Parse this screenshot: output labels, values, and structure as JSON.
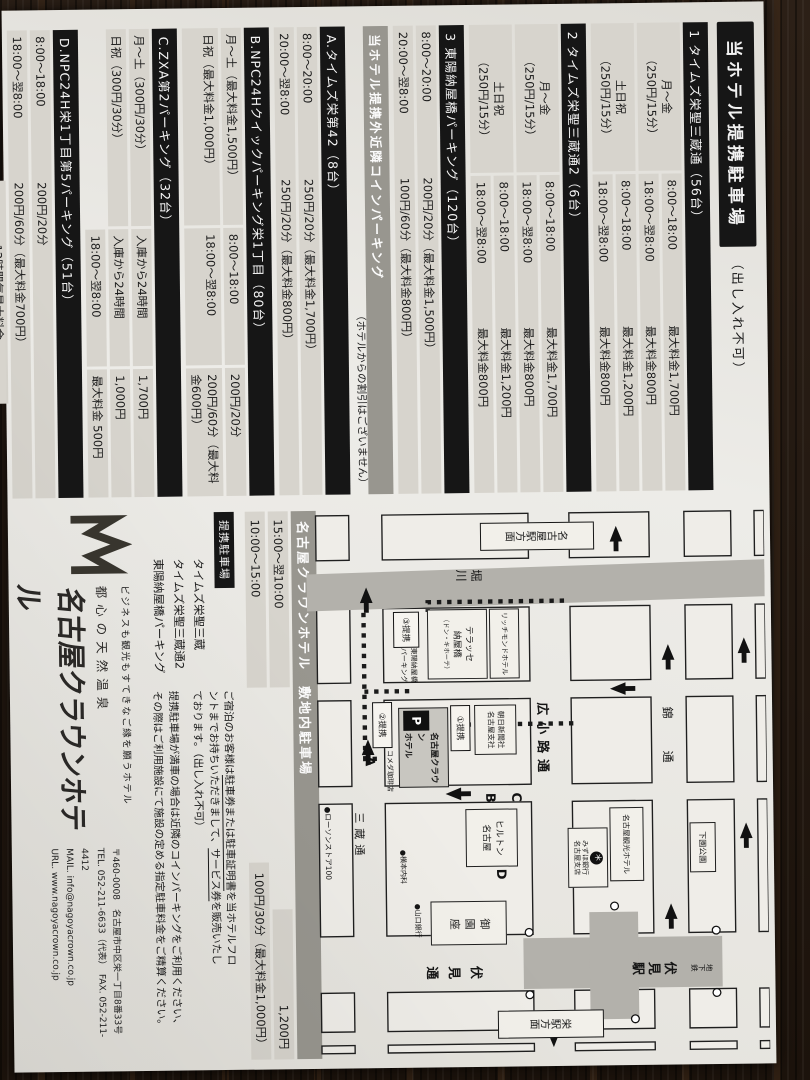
{
  "title": {
    "main": "当ホテル提携駐車場",
    "suffix": "（出し入れ不可）"
  },
  "partner_lots": [
    {
      "name": "1 タイムズ栄聖三蔵通（56台）",
      "groups": [
        {
          "label": "月～金",
          "rate": "（250円/15分）",
          "rows": [
            {
              "time": "8:00～18:00",
              "fee": "最大料金1,700円"
            },
            {
              "time": "18:00～翌8:00",
              "fee": "最大料金800円"
            }
          ]
        },
        {
          "label": "土日祝",
          "rate": "（250円/15分）",
          "rows": [
            {
              "time": "8:00～18:00",
              "fee": "最大料金1,200円"
            },
            {
              "time": "18:00～翌8:00",
              "fee": "最大料金800円"
            }
          ]
        }
      ]
    },
    {
      "name": "2 タイムズ栄聖三蔵通2（6台）",
      "groups": [
        {
          "label": "月～金",
          "rate": "（250円/15分）",
          "rows": [
            {
              "time": "8:00～18:00",
              "fee": "最大料金1,700円"
            },
            {
              "time": "18:00～翌8:00",
              "fee": "最大料金800円"
            }
          ]
        },
        {
          "label": "土日祝",
          "rate": "（250円/15分）",
          "rows": [
            {
              "time": "8:00～18:00",
              "fee": "最大料金1,200円"
            },
            {
              "time": "18:00～翌8:00",
              "fee": "最大料金800円"
            }
          ]
        }
      ]
    },
    {
      "name": "3 東陽納屋橋パーキング（120台）",
      "rows": [
        {
          "time": "8:00～20:00",
          "fee": "200円/20分（最大料金1,500円）"
        },
        {
          "time": "20:00～翌8:00",
          "fee": "100円/60分（最大料金800円）"
        }
      ]
    }
  ],
  "coin_section": {
    "title": "当ホテル提携外近隣コインパーキング",
    "note": "（ホテルからの割引はございません）"
  },
  "coin_lots": [
    {
      "name": "A.タイムズ栄第42（8台）",
      "rows": [
        {
          "time": "8:00～20:00",
          "fee": "250円/20分（最大料金1,700円）"
        },
        {
          "time": "20:00～翌8:00",
          "fee": "250円/20分（最大料金800円）"
        }
      ]
    },
    {
      "name": "B.NPC24Hクイックパーキング栄1丁目（80台）",
      "rows": [
        {
          "label": "月～土（最大料金1,500円）",
          "time": "8:00～18:00",
          "fee": "200円/20分"
        },
        {
          "label": "日祝（最大料金1,000円）",
          "time": "18:00～翌8:00",
          "fee": "200円/60分（最大料金600円）"
        }
      ]
    },
    {
      "name": "C.ZXA第2パーキング（32台）",
      "rows": [
        {
          "label": "月～土（300円/30分）",
          "time": "入庫から24時間",
          "fee": "1,700円"
        },
        {
          "label": "日祝（300円/30分）",
          "time": "入庫から24時間",
          "fee": "1,000円"
        },
        {
          "label": "",
          "time": "18:00～翌8:00",
          "fee": "最大料金 500円"
        }
      ]
    },
    {
      "name": "D.NPC24H栄1丁目第5パーキング（51台）",
      "rows": [
        {
          "time": "8:00～18:00",
          "fee": "200円/20分"
        },
        {
          "time": "18:00～翌8:00",
          "fee": "200円/60分（最大料金700円）"
        }
      ],
      "extra_label": "12時間毎最大料金",
      "extra_value": "2,000円"
    }
  ],
  "footnote": "※各コインパーキングの料金は2025年6月現在のものであり改定される場合がございます。予めご了承ください。",
  "onsite": {
    "title": "名古屋クラウンホテル　敷地内駐車場",
    "rows": [
      {
        "time": "15:00～翌10:00",
        "fee": "1,200円"
      },
      {
        "time": "10:00～15:00",
        "fee": "100円/30分（最大料金1,000円）"
      }
    ]
  },
  "tie_up": {
    "title": "提携駐車場",
    "list": [
      "タイムズ栄聖三蔵",
      "タイムズ栄聖三蔵通2",
      "東陽納屋橋パーキング"
    ],
    "p1a": "ご宿泊のお客様は",
    "p1b": "駐車券または駐車証明書",
    "p1c": "を当ホテルフロ",
    "p2a": "ントまでお持ちいただきまして、",
    "p2b": "サービス券",
    "p2c": "を販売いたし",
    "p3": "ております。（出し入れ不可）",
    "q1": "提携駐車場が満車の場合は近隣のコインパーキングをご利用ください、",
    "q2": "その際はご利用施設にて施設の定める指定駐車料金をご精算ください。"
  },
  "hotel": {
    "tagline": "ビジネスも観光もすてきなご縁を願うホテル",
    "onsen": "都心の天然温泉",
    "name": "名古屋クラウンホテル",
    "zip": "〒460-0008　名古屋市中区栄一丁目8番33号",
    "tel": "TEL. 052-211-6633（代表）　FAX. 052-211-4412",
    "mail": "MAIL. info@nagoyacrown.co.jp",
    "url": "URL. www.nagoyacrown.co.jp"
  },
  "map": {
    "horikawa": "堀川",
    "nishiki": "錦　通",
    "hirokoji": "広小路通",
    "sanzo": "三蔵通",
    "fushimi_dori": "伏見通",
    "subway": "地下鉄",
    "fushimi_sta": "伏見駅",
    "nagoya_sta": "名古屋駅方面",
    "sakae_sta": "栄駅方面",
    "shimozono": "下園公園",
    "kanko": "名古屋観光ホテル",
    "mizuho1": "みずほ銀行",
    "mizuho2": "名古屋支店",
    "bank_mark": "＊",
    "richmond": "リッチモンドホテル",
    "terrasse1": "テラッセ",
    "terrasse2": "納屋橋",
    "terrasse3": "（ドン・キホーテ）",
    "asahi1": "朝日新聞社",
    "asahi2": "名古屋支社",
    "hilton1": "ヒルトン",
    "hilton2": "名古屋",
    "misonoza": "御園座",
    "komeda": "コメダ珈琲店",
    "lawson": "●ローソンストア100",
    "yamaguchi": "●山口銀行",
    "yokomoto": "●横本内科",
    "crown1": "名古屋クラウン",
    "crown2": "ホテル",
    "p": "P",
    "toyo1": "東陽納屋橋",
    "toyo2": "パーキング",
    "m1": "①提携",
    "m2": "②提携",
    "m3": "③提携",
    "a": "A",
    "b": "B",
    "c": "C",
    "d": "D"
  }
}
